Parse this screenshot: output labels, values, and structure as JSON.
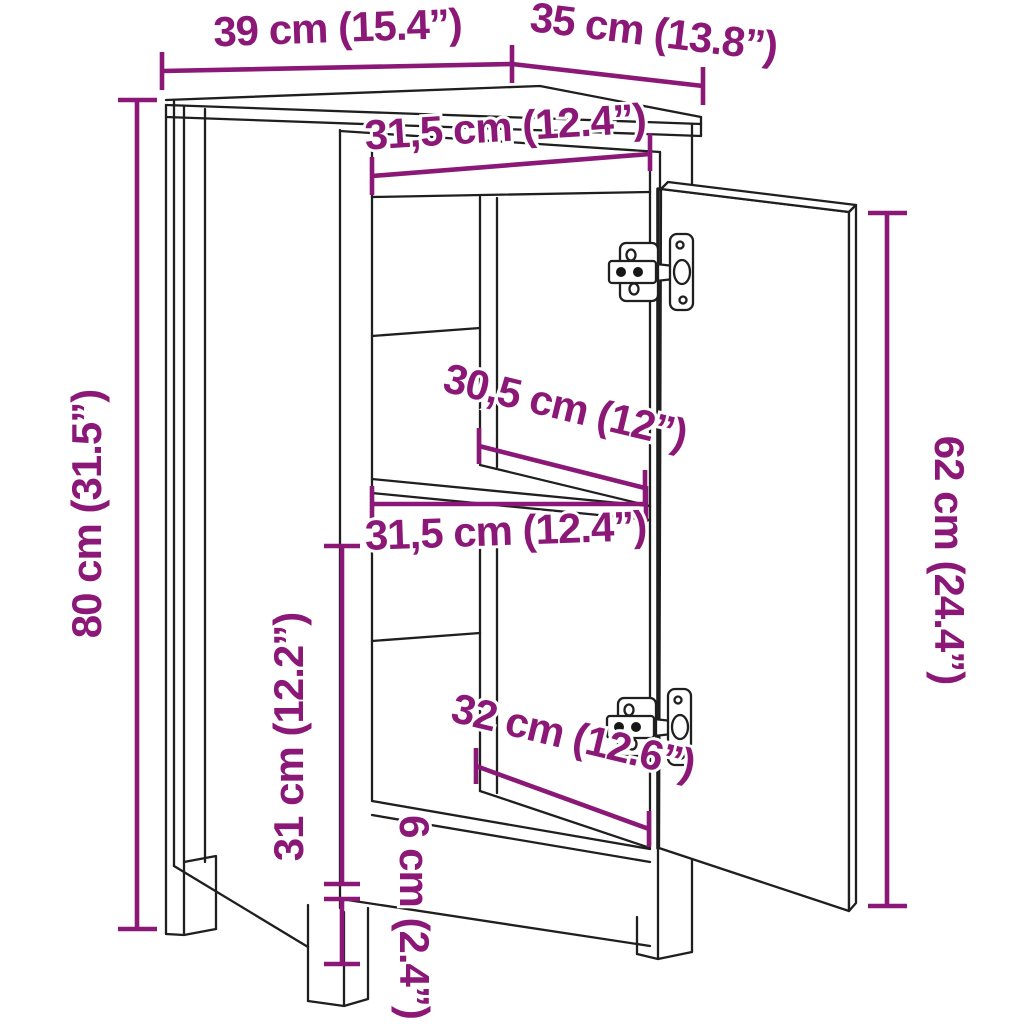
{
  "diagram": {
    "kind": "furniture-dimension-diagram",
    "subject": "cabinet-with-open-door",
    "background_color": "#ffffff",
    "line_color": "#1f1f1f",
    "dimension_color": "#8B1877",
    "dimensions": {
      "top_width": "39 cm (15.4”)",
      "top_depth": "35 cm (13.8”)",
      "opening_width_top": "31,5 cm (12.4”)",
      "overall_height": "80 cm (31.5”)",
      "shelf_depth": "30,5 cm (12”)",
      "opening_width_middle": "31,5 cm (12.4”)",
      "door_height": "62 cm (24.4”)",
      "lower_opening_height": "31 cm (12.2”)",
      "bottom_depth": "32 cm (12.6”)",
      "leg_height": "6 cm (2.4”)"
    }
  }
}
